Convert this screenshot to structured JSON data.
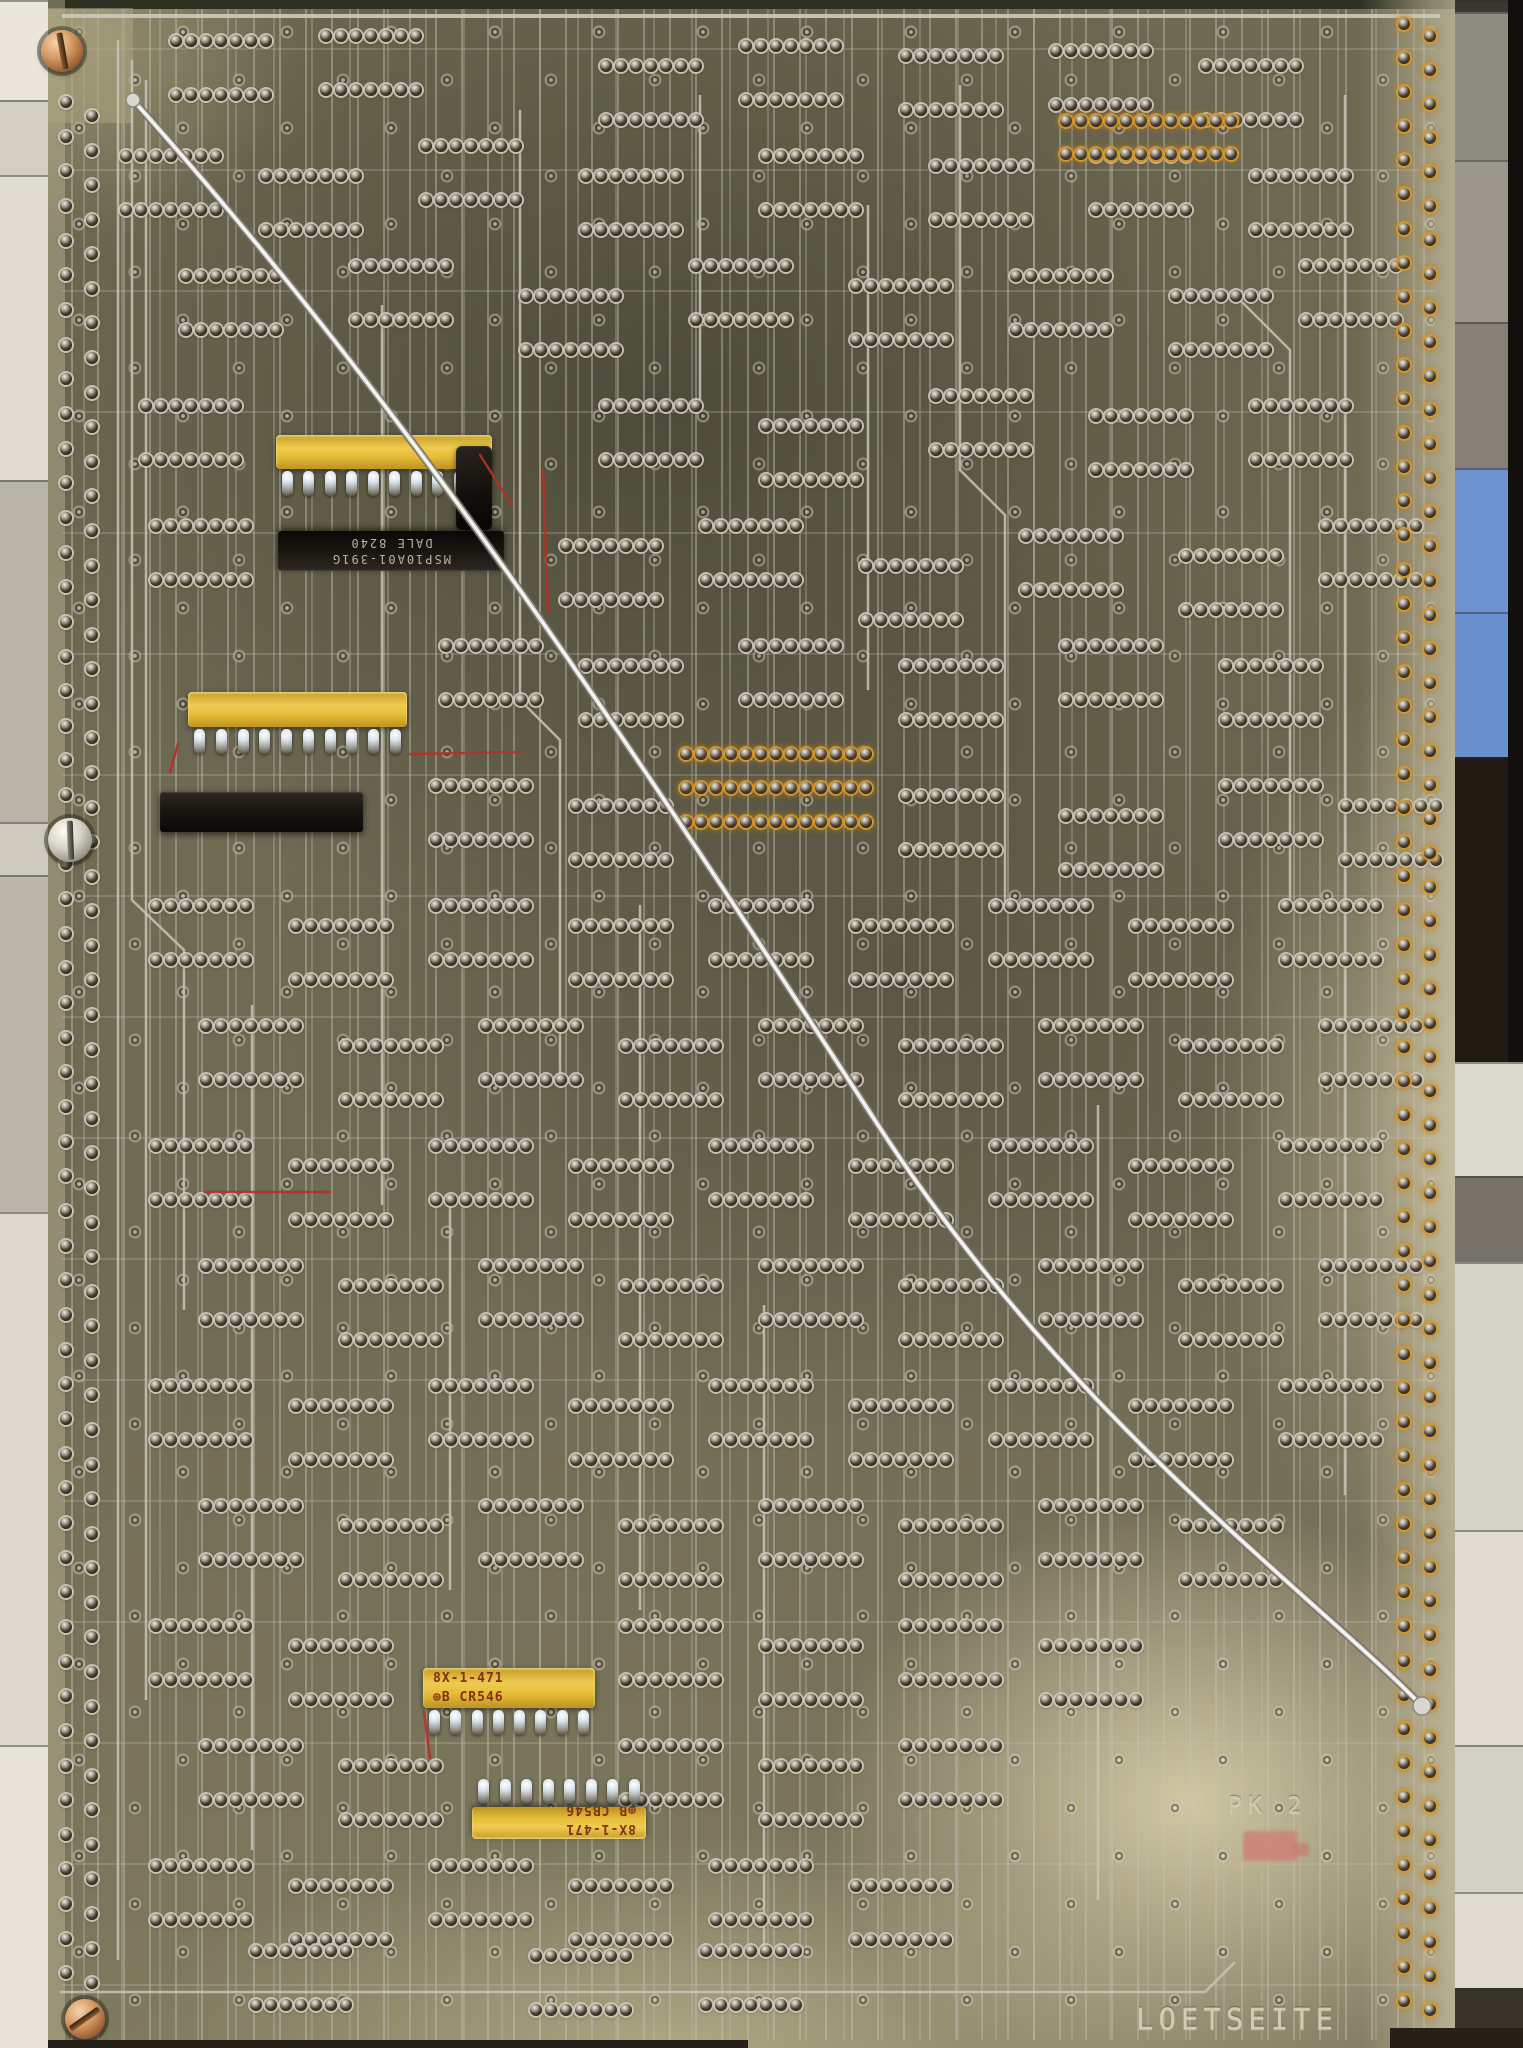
{
  "scene": {
    "description": "Scanned solder side (Loetseite) of a vintage through-hole printed circuit board with tinned traces, rows of solder pads, four yellow SIP resistor networks, black DIP components, brass mounting screws and one long silver bodge wire running diagonally across the board.",
    "etched_label": "LOETSEITE",
    "etched_mark": "PK 2"
  },
  "texts": {
    "loetseite": "LOETSEITE",
    "pk": "PK 2",
    "dip1_line1": "MSP10A01-391G",
    "dip1_line2": "DALE  8240",
    "rn3_line1": "8X-1-471",
    "rn3_line2": "⊕B CR546",
    "rn4_line1": "8X-1-471",
    "rn4_line2": "⊕B CB546"
  },
  "colors": {
    "board_olive": "#6f6a54",
    "board_pale": "#d6cdaa",
    "trace_silver": "#c9c6b7",
    "component_yellow": "#e6bd38",
    "component_black": "#16130f",
    "screw_copper": "#c08352",
    "flux_amber": "#ba7d20",
    "blue_block": "#6f93d2",
    "red_wire": "#b23127",
    "paint_mark": "#cd8076"
  },
  "layout": {
    "left_strip": [
      [
        0,
        100,
        "#eae6db"
      ],
      [
        100,
        175,
        "#d2cec2"
      ],
      [
        175,
        480,
        "#e0dcd1"
      ],
      [
        480,
        822,
        "#b8b4a8"
      ],
      [
        822,
        875,
        "#cfcbbf"
      ],
      [
        875,
        1212,
        "#bab6aa"
      ],
      [
        1212,
        1745,
        "#dcd8cd"
      ],
      [
        1745,
        2048,
        "#e8e4d9"
      ]
    ],
    "right_strip": [
      [
        0,
        12,
        "#3a3731",
        "background-segment"
      ],
      [
        12,
        160,
        "#8f8c82",
        "background-segment"
      ],
      [
        160,
        322,
        "#9b978d",
        "background-segment"
      ],
      [
        322,
        468,
        "#878077",
        "background-segment"
      ],
      [
        468,
        612,
        "#6f93d2",
        "blue-connector-block"
      ],
      [
        612,
        757,
        "#6b90d0",
        "blue-connector-block"
      ],
      [
        757,
        1062,
        "#1f1911",
        "background-segment"
      ],
      [
        1062,
        1176,
        "#dcd9ce",
        "background-segment"
      ],
      [
        1176,
        1262,
        "#76726a",
        "background-segment"
      ],
      [
        1262,
        1530,
        "#d6d3c8",
        "background-segment"
      ],
      [
        1530,
        1745,
        "#e0dcd1",
        "background-segment"
      ],
      [
        1745,
        1892,
        "#d3d0c5",
        "background-segment"
      ],
      [
        1892,
        1988,
        "#dfdbd0",
        "background-segment"
      ],
      [
        1988,
        2048,
        "#37332b",
        "background-segment"
      ]
    ],
    "edge_shadows": [
      [
        48,
        2040,
        700,
        8
      ],
      [
        1390,
        2028,
        133,
        20
      ]
    ],
    "screws": [
      {
        "x": 62,
        "y": 51,
        "r": 21,
        "type": "copper",
        "slot": 80
      },
      {
        "x": 70,
        "y": 840,
        "r": 22,
        "type": "silver",
        "slot": 88
      },
      {
        "x": 85,
        "y": 2019,
        "r": 20,
        "type": "copper",
        "slot": -35
      }
    ],
    "edge_pad_columns": [
      {
        "x": 60,
        "y0": 96,
        "y1": 1980,
        "n": 55,
        "amber": false
      },
      {
        "x": 86,
        "y0": 110,
        "y1": 1990,
        "n": 55,
        "amber": false
      },
      {
        "x": 1398,
        "y0": 18,
        "y1": 2008,
        "n": 59,
        "amber": true
      },
      {
        "x": 1424,
        "y0": 30,
        "y1": 2016,
        "n": 59,
        "amber": true
      }
    ],
    "ic_footprints": [
      [
        170,
        35
      ],
      [
        320,
        30
      ],
      [
        600,
        60
      ],
      [
        740,
        40
      ],
      [
        900,
        50
      ],
      [
        1050,
        45
      ],
      [
        1200,
        60
      ],
      [
        120,
        150
      ],
      [
        260,
        170
      ],
      [
        420,
        140
      ],
      [
        580,
        170
      ],
      [
        760,
        150
      ],
      [
        930,
        160
      ],
      [
        1090,
        150
      ],
      [
        1250,
        170
      ],
      [
        180,
        270
      ],
      [
        350,
        260
      ],
      [
        520,
        290
      ],
      [
        690,
        260
      ],
      [
        850,
        280
      ],
      [
        1010,
        270
      ],
      [
        1170,
        290
      ],
      [
        1300,
        260
      ],
      [
        140,
        400
      ],
      [
        600,
        400
      ],
      [
        760,
        420
      ],
      [
        930,
        390
      ],
      [
        1090,
        410
      ],
      [
        1250,
        400
      ],
      [
        150,
        520
      ],
      [
        560,
        540
      ],
      [
        700,
        520
      ],
      [
        860,
        560
      ],
      [
        1020,
        530
      ],
      [
        1180,
        550
      ],
      [
        1320,
        520
      ],
      [
        440,
        640
      ],
      [
        580,
        660
      ],
      [
        740,
        640
      ],
      [
        900,
        660
      ],
      [
        1060,
        640
      ],
      [
        1220,
        660
      ],
      [
        430,
        780
      ],
      [
        570,
        800
      ],
      [
        900,
        790
      ],
      [
        1060,
        810
      ],
      [
        1220,
        780
      ],
      [
        1340,
        800
      ],
      [
        150,
        900
      ],
      [
        290,
        920
      ],
      [
        430,
        900
      ],
      [
        570,
        920
      ],
      [
        710,
        900
      ],
      [
        850,
        920
      ],
      [
        990,
        900
      ],
      [
        1130,
        920
      ],
      [
        1280,
        900
      ],
      [
        200,
        1020
      ],
      [
        340,
        1040
      ],
      [
        480,
        1020
      ],
      [
        620,
        1040
      ],
      [
        760,
        1020
      ],
      [
        900,
        1040
      ],
      [
        1040,
        1020
      ],
      [
        1180,
        1040
      ],
      [
        1320,
        1020
      ],
      [
        150,
        1140
      ],
      [
        290,
        1160
      ],
      [
        430,
        1140
      ],
      [
        570,
        1160
      ],
      [
        710,
        1140
      ],
      [
        850,
        1160
      ],
      [
        990,
        1140
      ],
      [
        1130,
        1160
      ],
      [
        1280,
        1140
      ],
      [
        200,
        1260
      ],
      [
        340,
        1280
      ],
      [
        480,
        1260
      ],
      [
        620,
        1280
      ],
      [
        760,
        1260
      ],
      [
        900,
        1280
      ],
      [
        1040,
        1260
      ],
      [
        1180,
        1280
      ],
      [
        1320,
        1260
      ],
      [
        150,
        1380
      ],
      [
        290,
        1400
      ],
      [
        430,
        1380
      ],
      [
        570,
        1400
      ],
      [
        710,
        1380
      ],
      [
        850,
        1400
      ],
      [
        990,
        1380
      ],
      [
        1130,
        1400
      ],
      [
        1280,
        1380
      ],
      [
        200,
        1500
      ],
      [
        340,
        1520
      ],
      [
        480,
        1500
      ],
      [
        620,
        1520
      ],
      [
        760,
        1500
      ],
      [
        900,
        1520
      ],
      [
        1040,
        1500
      ],
      [
        1180,
        1520
      ],
      [
        150,
        1620
      ],
      [
        290,
        1640
      ],
      [
        620,
        1620
      ],
      [
        760,
        1640
      ],
      [
        900,
        1620
      ],
      [
        1040,
        1640
      ],
      [
        200,
        1740
      ],
      [
        340,
        1760
      ],
      [
        620,
        1740
      ],
      [
        760,
        1760
      ],
      [
        900,
        1740
      ],
      [
        150,
        1860
      ],
      [
        290,
        1880
      ],
      [
        430,
        1860
      ],
      [
        570,
        1880
      ],
      [
        710,
        1860
      ],
      [
        850,
        1880
      ],
      [
        250,
        1945
      ],
      [
        530,
        1950
      ],
      [
        700,
        1945
      ]
    ],
    "flux_pad_rows": [
      [
        680,
        748,
        13
      ],
      [
        680,
        782,
        13
      ],
      [
        680,
        816,
        13
      ],
      [
        1060,
        115,
        12
      ],
      [
        1060,
        148,
        12
      ]
    ],
    "resistor_networks": [
      {
        "x": 276,
        "y": 435,
        "w": 216,
        "h": 34,
        "pins": 10,
        "pinside": 1,
        "flip": false,
        "labels": []
      },
      {
        "x": 188,
        "y": 692,
        "w": 219,
        "h": 35,
        "pins": 10,
        "pinside": 1,
        "flip": false,
        "labels": []
      },
      {
        "x": 423,
        "y": 1668,
        "w": 172,
        "h": 40,
        "pins": 8,
        "pinside": 1,
        "flip": false,
        "labels": [
          "texts.rn3_line1",
          "texts.rn3_line2"
        ]
      },
      {
        "x": 472,
        "y": 1807,
        "w": 174,
        "h": 32,
        "pins": 8,
        "pinside": -1,
        "flip": true,
        "labels": [
          "texts.rn4_line1",
          "texts.rn4_line2"
        ]
      }
    ],
    "dips": [
      {
        "x": 278,
        "y": 531,
        "w": 226,
        "h": 40,
        "flip": true,
        "labels": [
          "texts.dip1_line1",
          "texts.dip1_line2"
        ]
      },
      {
        "x": 160,
        "y": 792,
        "w": 203,
        "h": 40,
        "flip": false,
        "labels": []
      }
    ],
    "misc_components": [
      {
        "x": 456,
        "y": 446,
        "w": 36,
        "h": 84
      }
    ],
    "traces": [
      {
        "bus": true,
        "pts": "62,16 1440,16"
      },
      {
        "pts": "118,40 118,1960"
      },
      {
        "pts": "132,60 132,900 184,950 184,1310"
      },
      {
        "pts": "146,80 146,1700"
      },
      {
        "pts": "520,110 520,700 560,740 560,1080"
      },
      {
        "pts": "960,85 960,470 1005,515 1005,905"
      },
      {
        "pts": "1345,95 1345,1495"
      },
      {
        "pts": "640,905 640,1610"
      },
      {
        "pts": "252,1005 252,1850"
      },
      {
        "pts": "1098,1105 1098,1900"
      },
      {
        "pts": "382,305 382,1205"
      },
      {
        "pts": "764,1305 764,1950"
      },
      {
        "pts": "60,1992 1205,1992 1235,1962"
      },
      {
        "pts": "868,205 868,690"
      },
      {
        "pts": "1240,300 1290,350 1290,900"
      },
      {
        "pts": "450,1200 450,1590"
      },
      {
        "pts": "700,95 700,400"
      }
    ],
    "red_wires": [
      "543,470 548,612",
      "480,455 512,505",
      "178,744 170,772",
      "410,754 520,752",
      "424,1712 430,1758",
      "205,1192 330,1192"
    ],
    "jumper_wire": {
      "path": "M133,100 C 420,420 640,760 880,1128 C 1070,1420 1320,1600 1422,1706",
      "start": [
        133,
        100
      ],
      "end": [
        1422,
        1706
      ]
    }
  }
}
